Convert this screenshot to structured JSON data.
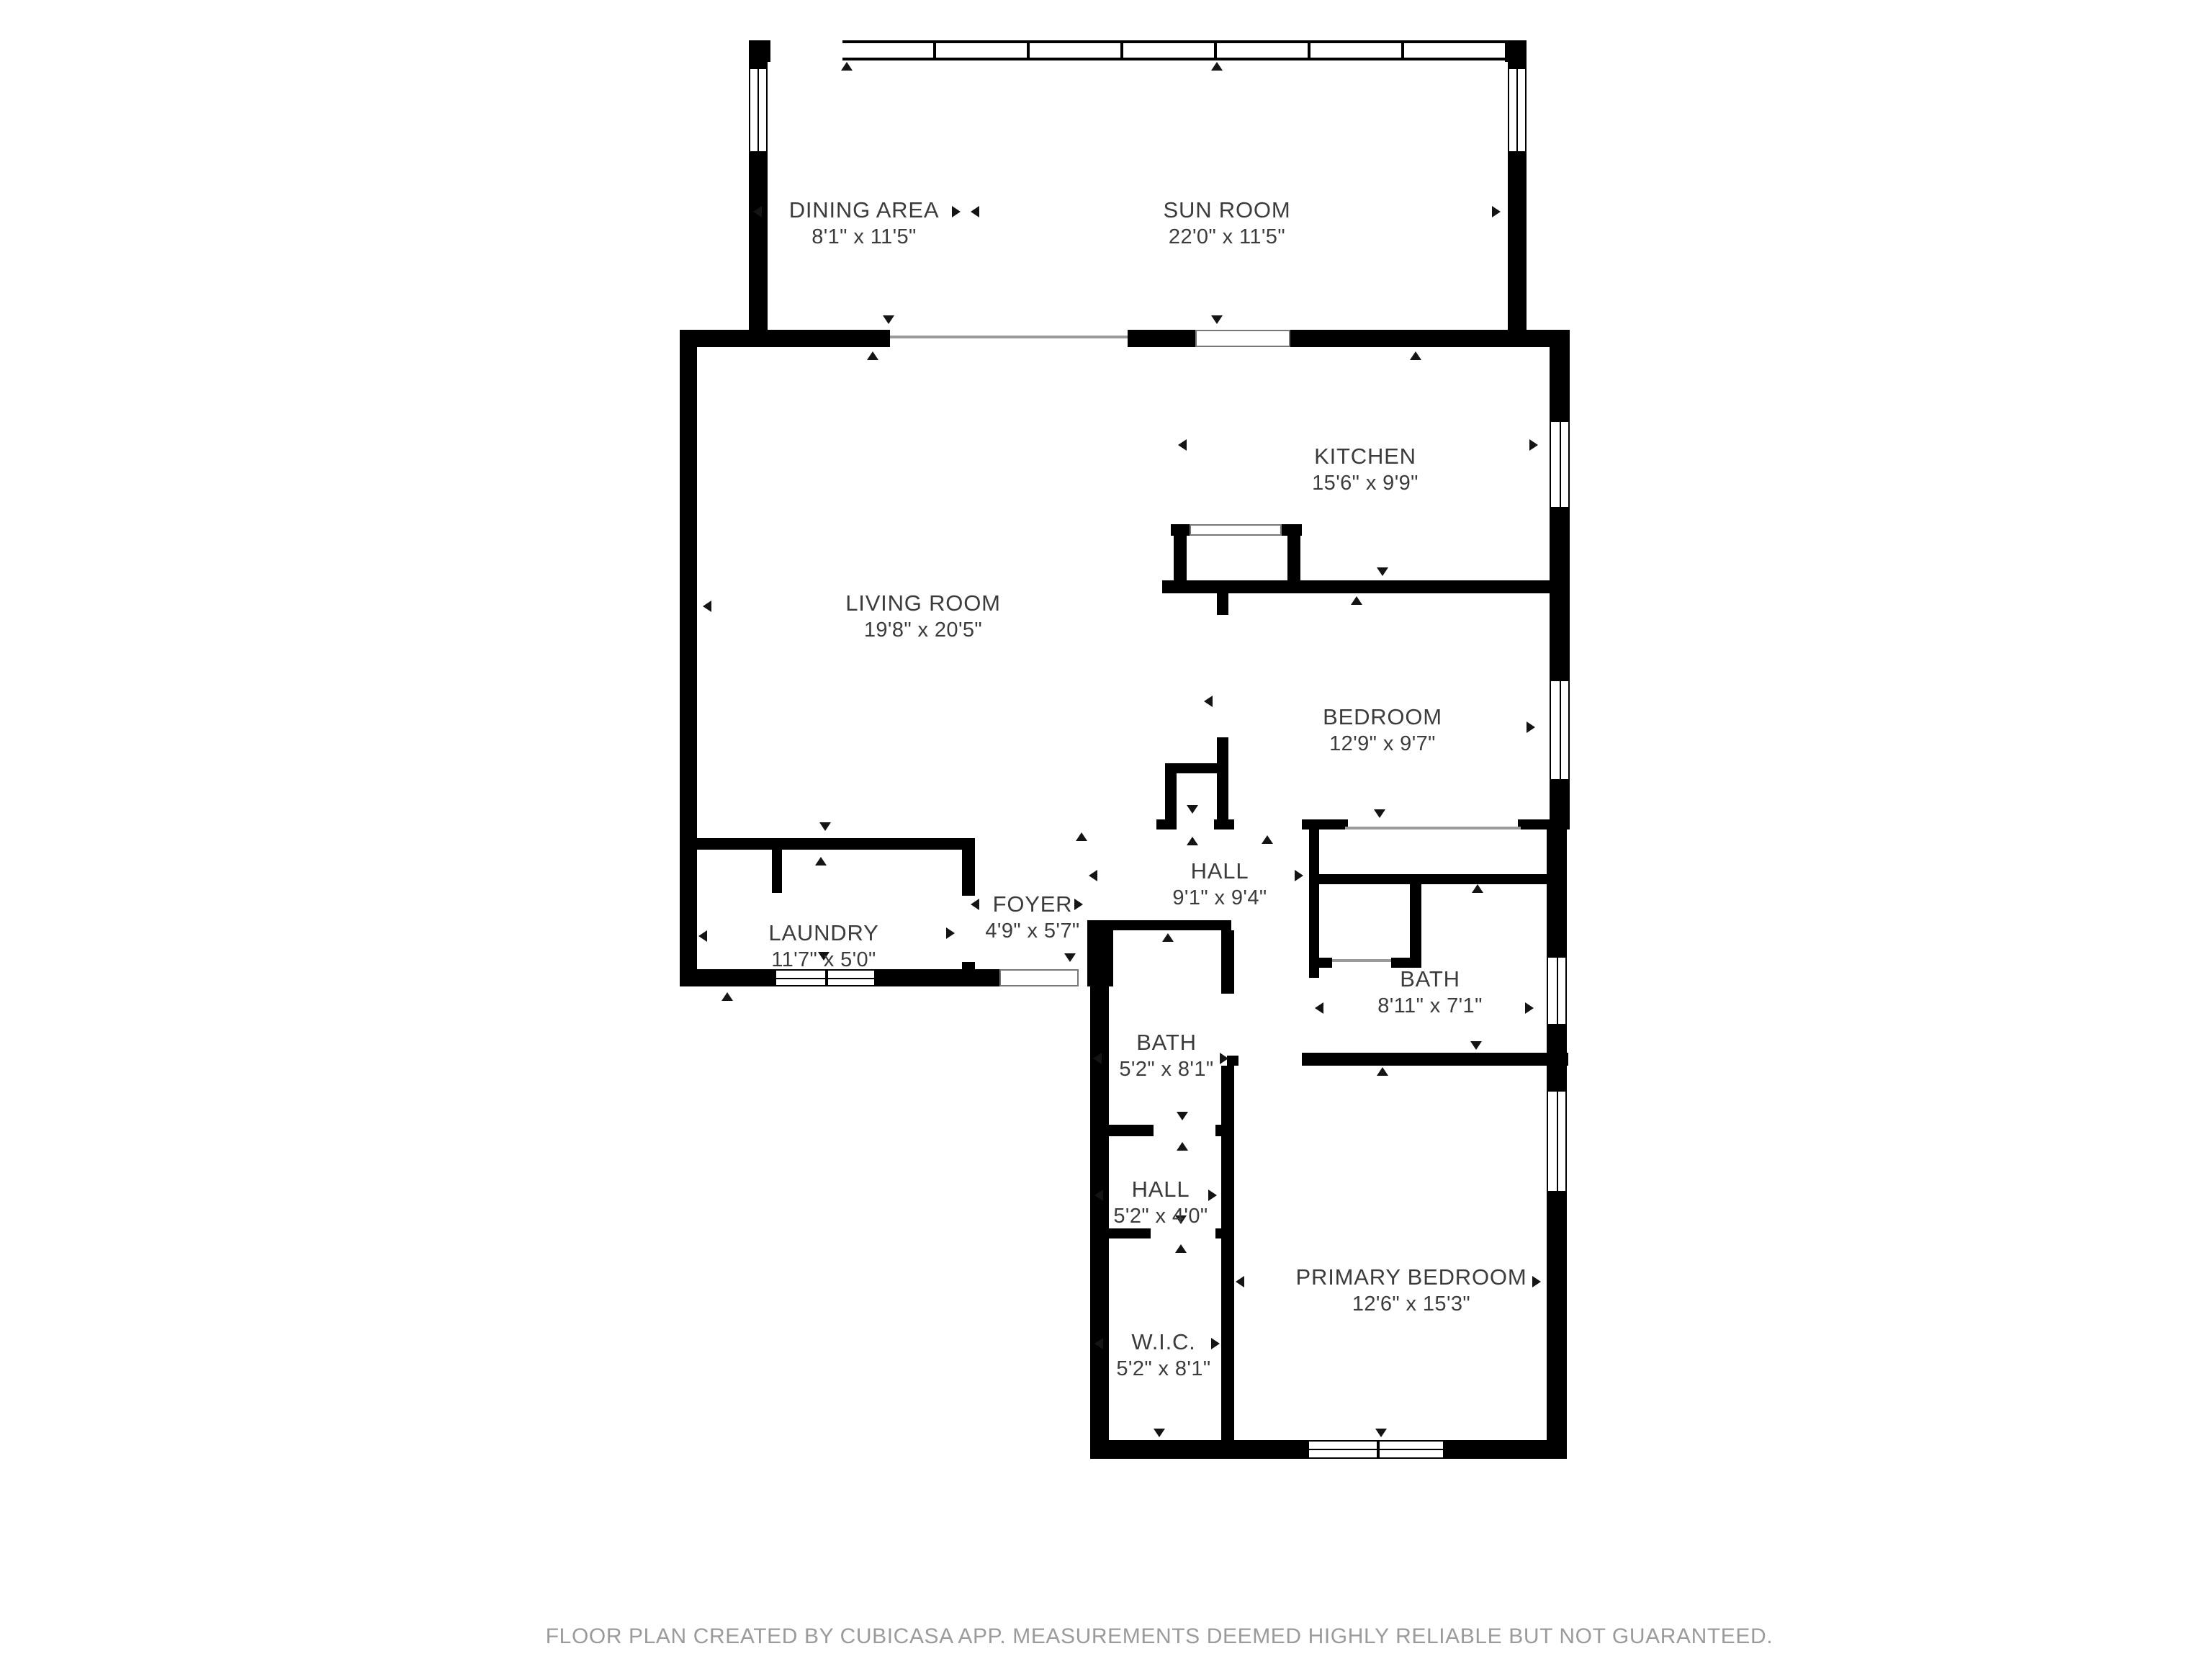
{
  "title": "Floor plan",
  "colors": {
    "wall": "#000000",
    "label": "#3c3c3c",
    "opening": "#9a9a9a",
    "footer": "#9b9b9b",
    "paper": "#ffffff"
  },
  "rooms": [
    {
      "id": "dining-area",
      "name": "DINING AREA",
      "dims": "8'1\" x 11'5\""
    },
    {
      "id": "sun-room",
      "name": "SUN ROOM",
      "dims": "22'0\" x 11'5\""
    },
    {
      "id": "kitchen",
      "name": "KITCHEN",
      "dims": "15'6\" x 9'9\""
    },
    {
      "id": "living-room",
      "name": "LIVING ROOM",
      "dims": "19'8\" x 20'5\""
    },
    {
      "id": "bedroom",
      "name": "BEDROOM",
      "dims": "12'9\" x 9'7\""
    },
    {
      "id": "hall",
      "name": "HALL",
      "dims": "9'1\" x 9'4\""
    },
    {
      "id": "laundry",
      "name": "LAUNDRY",
      "dims": "11'7\" x 5'0\""
    },
    {
      "id": "foyer",
      "name": "FOYER",
      "dims": "4'9\" x 5'7\""
    },
    {
      "id": "bath",
      "name": "BATH",
      "dims": "8'11\" x 7'1\""
    },
    {
      "id": "bath-2",
      "name": "BATH",
      "dims": "5'2\" x 8'1\""
    },
    {
      "id": "hall-2",
      "name": "HALL",
      "dims": "5'2\" x 4'0\""
    },
    {
      "id": "wic",
      "name": "W.I.C.",
      "dims": "5'2\" x 8'1\""
    },
    {
      "id": "primary-bedroom",
      "name": "PRIMARY BEDROOM",
      "dims": "12'6\" x 15'3\""
    }
  ],
  "footer": {
    "text": "FLOOR PLAN CREATED BY CUBICASA APP. MEASUREMENTS DEEMED HIGHLY RELIABLE BUT NOT GUARANTEED."
  }
}
